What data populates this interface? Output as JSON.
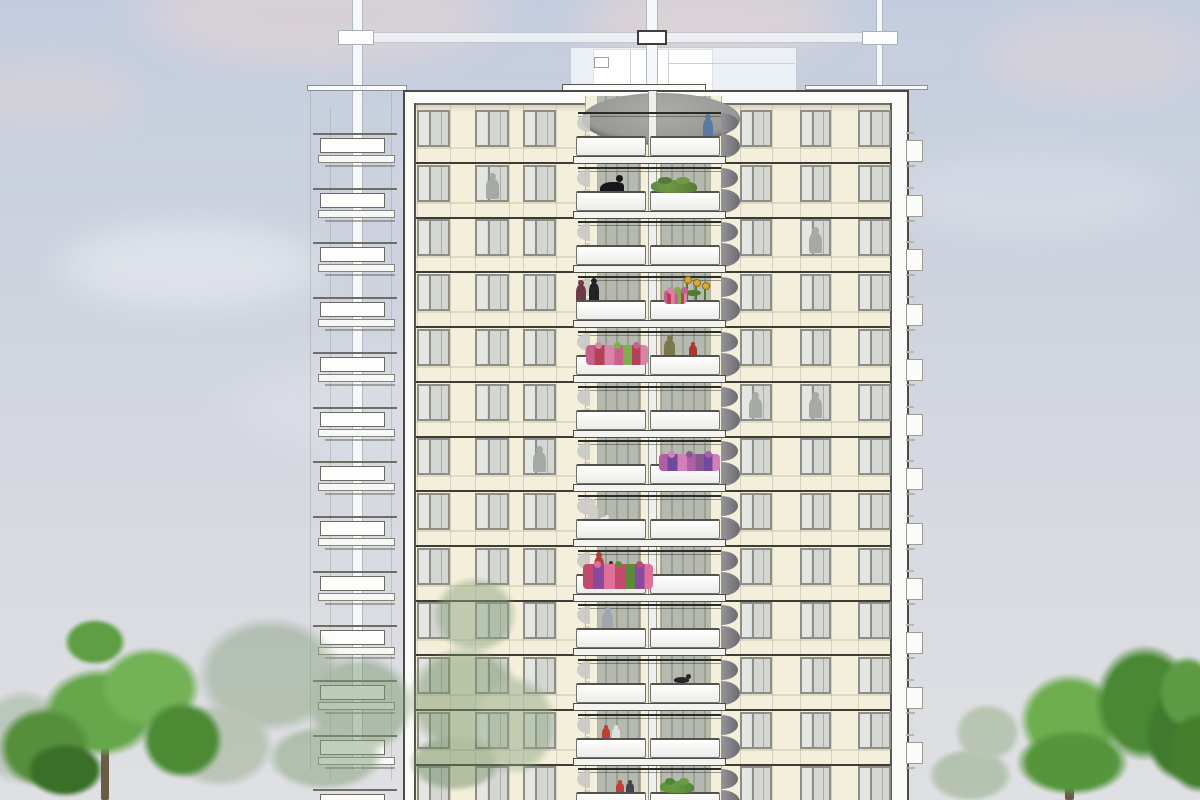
{
  "scene": "residential-tower-elevation-drawing",
  "palette": {
    "sky_top": "#c4cddf",
    "sky_mid1": "#ccd2de",
    "sky_mid2": "#d5d8e0",
    "sky_bottom": "#dfe0e3",
    "cloud_pink": "#e7d5d2",
    "cloud_white": "#eef0f4",
    "facade": "#f4efdb",
    "facade_line": "#3c3c35",
    "frame_white": "#fbfbfa",
    "frame_edge": "#4b4b44",
    "win_frame": "#8e8e86",
    "win_glass_light": "#e4e6e3",
    "win_glass": "#d3d6d1",
    "silhouette": "#a7aaa4",
    "recess_a": "#b5b9af",
    "recess_b": "#9aa092",
    "parapet_edge": "#73736b",
    "slab_edge": "#4e4e47",
    "canopy_a": "#ababa9",
    "canopy_b": "#8f8f8c",
    "screen_dark_a": "#95959a",
    "screen_dark_b": "#6b6b70",
    "screen_light": "#c9cac6",
    "ghost_fill": "rgba(243,245,248,0.8)",
    "ghost_edge": "rgba(160,166,176,0.55)",
    "mast_fill": "#f5f7f9",
    "mast_edge": "rgba(150,156,166,0.7)",
    "side_win": "#fbfbfa",
    "side_win_edge": "#9b9b94",
    "trunk": "#6b5b47",
    "flower_palettes": {
      "pink": [
        "#c9608c",
        "#b34057",
        "#d884a8",
        "#7fae4e"
      ],
      "violet": [
        "#b05fa5",
        "#6f4a9c",
        "#d27fb8",
        "#87578f"
      ],
      "mixed": [
        "#c24a6e",
        "#8a4a9e",
        "#e0709a",
        "#5d8a3a"
      ]
    }
  },
  "sky": {
    "clouds": [
      [
        60,
        -60,
        520,
        150,
        "pink",
        0.55
      ],
      [
        520,
        -40,
        380,
        120,
        "pink",
        0.6
      ],
      [
        930,
        -10,
        330,
        130,
        "pink",
        0.4
      ],
      [
        -80,
        40,
        260,
        110,
        "pink",
        0.35
      ],
      [
        0,
        200,
        380,
        130,
        "white",
        0.5
      ],
      [
        330,
        110,
        420,
        140,
        "white",
        0.3
      ],
      [
        820,
        130,
        420,
        130,
        "white",
        0.25
      ],
      [
        150,
        330,
        500,
        150,
        "white",
        0.22
      ]
    ]
  },
  "rooftop": {
    "ghost_vlines": [
      [
        310,
        88,
        682
      ],
      [
        330,
        108,
        672
      ],
      [
        391,
        88,
        692
      ]
    ],
    "beam": [
      342,
      32,
      541,
      11
    ],
    "penthouse": {
      "box": [
        570,
        47,
        227,
        51
      ],
      "inner": [
        593,
        49,
        120,
        49
      ],
      "vent": [
        594,
        57,
        15,
        11
      ],
      "vlines": [
        630,
        668
      ],
      "hline": [
        668,
        63,
        127
      ]
    },
    "masts": [
      [
        352,
        0,
        11,
        770
      ],
      [
        646,
        0,
        12,
        96
      ],
      [
        876,
        0,
        7,
        98
      ]
    ],
    "slabs": [
      [
        307,
        85,
        100,
        6
      ],
      [
        562,
        84,
        144,
        8
      ],
      [
        805,
        85,
        123,
        5
      ]
    ],
    "collars": [
      [
        338,
        30,
        36,
        15,
        "light"
      ],
      [
        637,
        30,
        30,
        15,
        "dark"
      ],
      [
        862,
        31,
        36,
        14,
        "light"
      ]
    ]
  },
  "ghost_balconies": {
    "count": 13,
    "v0": 138,
    "pitch": 54.7,
    "line": [
      313,
      -5,
      84,
      2
    ],
    "box": [
      320,
      0,
      65,
      15
    ],
    "slab": [
      318,
      17,
      77,
      8
    ],
    "line2": [
      325,
      27,
      70,
      2
    ]
  },
  "building": {
    "outer": [
      403,
      90,
      506,
      710
    ],
    "facade": [
      416,
      104,
      474,
      696
    ],
    "inner_left": 414,
    "inner_right": 890,
    "inner_top": 103,
    "b0": 110,
    "pitch": 54.7,
    "floors": 13,
    "win_h": 37,
    "line_off": 52,
    "cols": [
      [
        417,
        33
      ],
      [
        475,
        34
      ],
      [
        523,
        33
      ],
      [
        740,
        32
      ],
      [
        800,
        31
      ],
      [
        858,
        33
      ]
    ],
    "silhouettes": [
      [
        486,
        1
      ],
      [
        533,
        6
      ],
      [
        749,
        5
      ],
      [
        809,
        5
      ],
      [
        809,
        2
      ]
    ]
  },
  "balcony": {
    "recess": [
      585,
      96,
      137,
      704
    ],
    "piers": [
      [
        585,
        13
      ],
      [
        640,
        21
      ],
      [
        710,
        12
      ]
    ],
    "rail": [
      578,
      143
    ],
    "parapet_l": [
      576,
      70
    ],
    "parapet_r": [
      650,
      70
    ],
    "parapet_off": 26,
    "parapet_h": 20,
    "slab": [
      573,
      153,
      46,
      8
    ],
    "mast": [
      648,
      91,
      9,
      709
    ],
    "canopy": [
      582,
      93,
      158,
      52
    ],
    "screen_r_x": 721,
    "screen_l_x": 575
  },
  "side_windows": {
    "x": 906,
    "w": 17,
    "win_off": 30,
    "win_h": 22,
    "tick_off": 22,
    "count": 12
  },
  "balcony_items": [
    [
      0,
      "person",
      703,
      10,
      24,
      "#5b79a0"
    ],
    [
      1,
      "crouch",
      600,
      24,
      20,
      "#17171a"
    ],
    [
      1,
      "shrub",
      651,
      46,
      13,
      "#567a36"
    ],
    [
      3,
      "person",
      576,
      10,
      22,
      "#6e3a4a"
    ],
    [
      3,
      "person",
      589,
      10,
      24,
      "#222228"
    ],
    [
      3,
      "flowerbox",
      664,
      23,
      14,
      "pink"
    ],
    [
      3,
      "sunflowers",
      681,
      27,
      24,
      ""
    ],
    [
      4,
      "flowerbox",
      586,
      62,
      20,
      "pink"
    ],
    [
      4,
      "person",
      664,
      11,
      22,
      "#79774b"
    ],
    [
      4,
      "person",
      689,
      8,
      15,
      "#a83a33"
    ],
    [
      6,
      "flowerbox",
      659,
      61,
      17,
      "violet"
    ],
    [
      7,
      "person",
      588,
      10,
      22,
      "#cfcfc8"
    ],
    [
      7,
      "dog",
      600,
      9,
      6,
      "#e6e6e1"
    ],
    [
      8,
      "flowerbox",
      583,
      70,
      25,
      "mixed"
    ],
    [
      8,
      "person",
      594,
      10,
      24,
      "#b23f38"
    ],
    [
      8,
      "person",
      607,
      8,
      15,
      "#33333a"
    ],
    [
      9,
      "person",
      602,
      11,
      23,
      "#9fa6ad"
    ],
    [
      10,
      "cat",
      674,
      18,
      9,
      "#26262b"
    ],
    [
      11,
      "person",
      602,
      8,
      15,
      "#bf3e36"
    ],
    [
      11,
      "person",
      612,
      8,
      15,
      "#e0e0da"
    ],
    [
      12,
      "person",
      616,
      8,
      14,
      "#bf3e36"
    ],
    [
      12,
      "person",
      626,
      8,
      14,
      "#44444c"
    ],
    [
      12,
      "shrub",
      660,
      34,
      12,
      "#4c8833"
    ]
  ],
  "trees": [
    {
      "name": "tree-far-left-faint",
      "opacity": 0.4,
      "blobs": [
        [
          -35,
          675,
          115,
          125,
          "#8da585"
        ]
      ]
    },
    {
      "name": "tree-left-faded",
      "opacity": 0.5,
      "blobs": [
        [
          175,
          600,
          190,
          150,
          "#8fa486"
        ],
        [
          290,
          640,
          140,
          130,
          "#7e9a74"
        ],
        [
          150,
          690,
          140,
          110,
          "#97ab8d"
        ],
        [
          250,
          715,
          150,
          85,
          "#84a07a"
        ]
      ]
    },
    {
      "name": "tree-front-center",
      "opacity": 0.48,
      "blobs": [
        [
          420,
          565,
          110,
          100,
          "#8aa37e"
        ],
        [
          390,
          630,
          150,
          140,
          "#7d986f"
        ],
        [
          460,
          660,
          110,
          130,
          "#8fa883"
        ],
        [
          395,
          725,
          120,
          75,
          "#6f8a63"
        ]
      ]
    },
    {
      "name": "tree-right-faded",
      "opacity": 0.55,
      "blobs": [
        [
          915,
          740,
          110,
          70,
          "#93ac88"
        ],
        [
          945,
          695,
          85,
          75,
          "#9ab18e"
        ]
      ]
    },
    {
      "name": "tree-left-bright",
      "opacity": 1,
      "blobs": [
        [
          25,
          655,
          150,
          115,
          "#67a74c"
        ],
        [
          -15,
          695,
          120,
          105,
          "#568f3b"
        ],
        [
          85,
          635,
          130,
          105,
          "#74b258"
        ],
        [
          130,
          690,
          105,
          100,
          "#4c8a34"
        ],
        [
          15,
          735,
          100,
          70,
          "#3a6f28"
        ],
        [
          55,
          612,
          80,
          60,
          "#5f9e44"
        ]
      ],
      "trunk": [
        101,
        742,
        8,
        58
      ]
    },
    {
      "name": "tree-right-bright",
      "opacity": 1,
      "blobs": [
        [
          1005,
          660,
          130,
          120,
          "#6fae4f"
        ],
        [
          1080,
          628,
          130,
          150,
          "#4a8833"
        ],
        [
          1135,
          675,
          90,
          120,
          "#3f7a2f"
        ],
        [
          1000,
          720,
          145,
          85,
          "#55963d"
        ],
        [
          1150,
          645,
          75,
          95,
          "#5d9c44"
        ],
        [
          1155,
          700,
          90,
          105,
          "#447f2e"
        ]
      ],
      "trunk": [
        1065,
        765,
        9,
        35
      ]
    }
  ]
}
